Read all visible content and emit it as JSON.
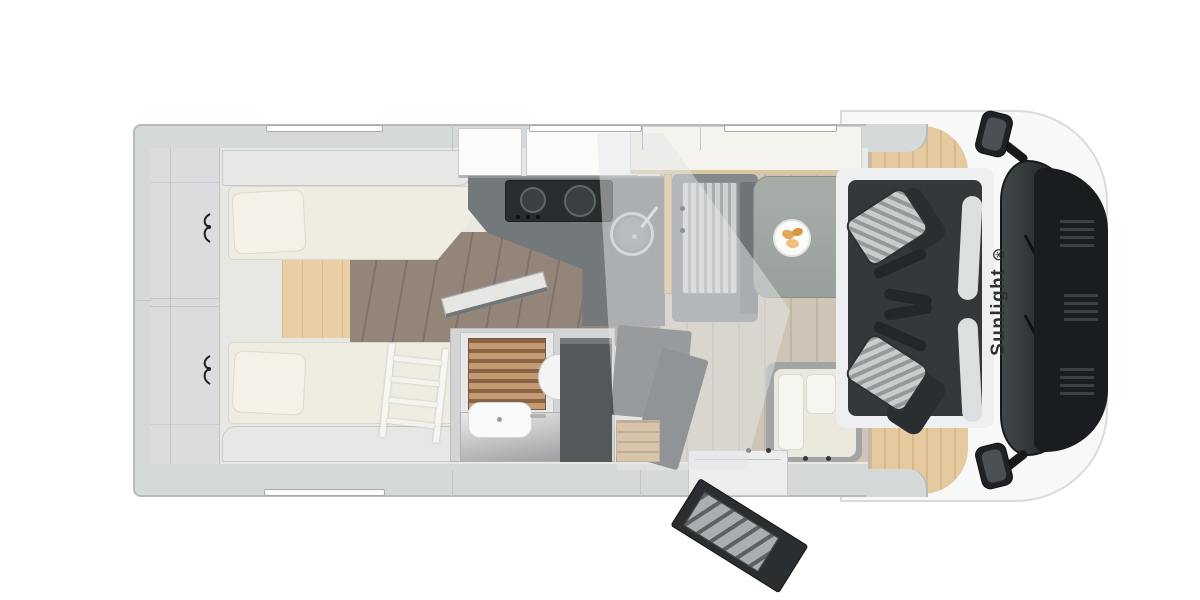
{
  "title": "Sunlight motorhome floor plan (top view)",
  "brand": {
    "label": "Sunlight",
    "logo_glyph": "⊛",
    "text_color": "#2d3032"
  },
  "palette": {
    "background": "#ffffff",
    "body_wall_grey": "#d6d9da",
    "cab_shell_white": "#f7f8f8",
    "cab_wood_floor": "#e5c99f",
    "mattress_cream": "#efece2",
    "wood_step_light": "#e9cea6",
    "rear_floor_planks": "#93857a",
    "lounge_floor": "#cfc5b6",
    "kitchen_counter": "#73787a",
    "stove_black": "#2a2d2f",
    "wardrobe_dark": "#54585b",
    "shower_teak": "#c49b72",
    "cab_floor_dark": "#34383b",
    "seat_fabric_stripe": "#c9cccd",
    "table_grey": "#a1a6a2",
    "windshield_dark": "#2a2f31",
    "hood_black": "#1a1d1f",
    "plate_food": "#e2a75c"
  },
  "windows": {
    "top_wall_count": 3,
    "bottom_wall_count": 1
  },
  "furniture": [
    "rear-single-bed-top",
    "rear-single-bed-bottom",
    "bed-ladder",
    "reading-lamps",
    "rear-wardrobe-shelves",
    "overhead-lockers",
    "kitchen-counter",
    "gas-hob",
    "round-sink",
    "drop-down-bed-panel",
    "dinette-bench-striped",
    "dinette-bench-corner",
    "dinette-table",
    "breakfast-plate",
    "bathroom-shower-teak-grate",
    "toilet",
    "washbasin",
    "tall-wardrobe",
    "entry-step",
    "entry-door-open",
    "driver-seat-swiveled",
    "passenger-seat-swiveled",
    "cab-windshield",
    "side-mirror-left",
    "side-mirror-right"
  ]
}
